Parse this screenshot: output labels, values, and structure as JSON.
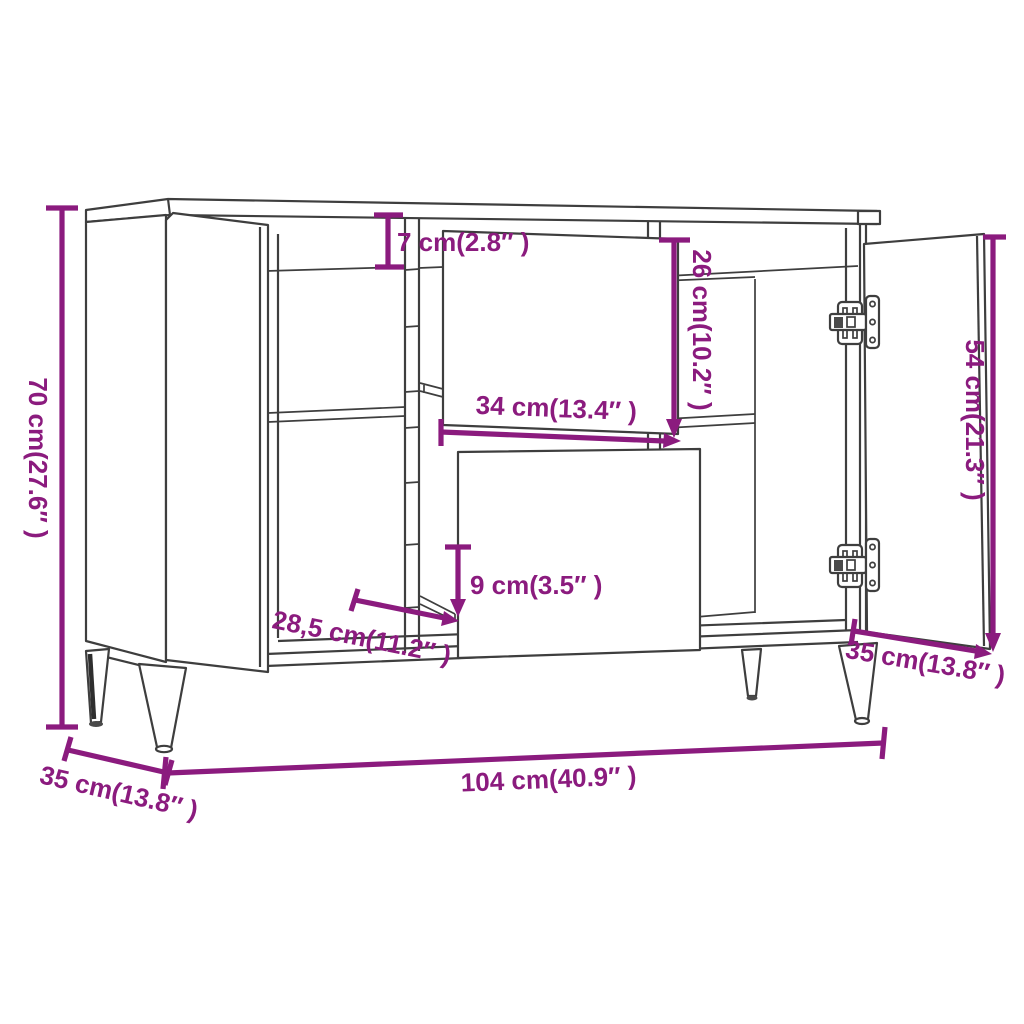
{
  "diagram": {
    "title": "sideboard-dimension-diagram",
    "colors": {
      "background": "#ffffff",
      "outline": "#3e3e3e",
      "dimension": "#8b1b7e"
    },
    "dimensions": {
      "overall_height": "70 cm(27.6″ )",
      "top_drawer_height": "7 cm(2.8″ )",
      "drawer_front_height": "26 cm(10.2″ )",
      "drawer_front_width": "34 cm(13.4″ )",
      "door_height": "54 cm(21.3″ )",
      "bottom_drawer_gap": "9 cm(3.5″ )",
      "interior_depth": "28,5 cm(11.2″ )",
      "overall_depth": "35 cm(13.8″ )",
      "overall_width": "104 cm(40.9″ )",
      "door_width": "35 cm(13.8″ )"
    }
  }
}
